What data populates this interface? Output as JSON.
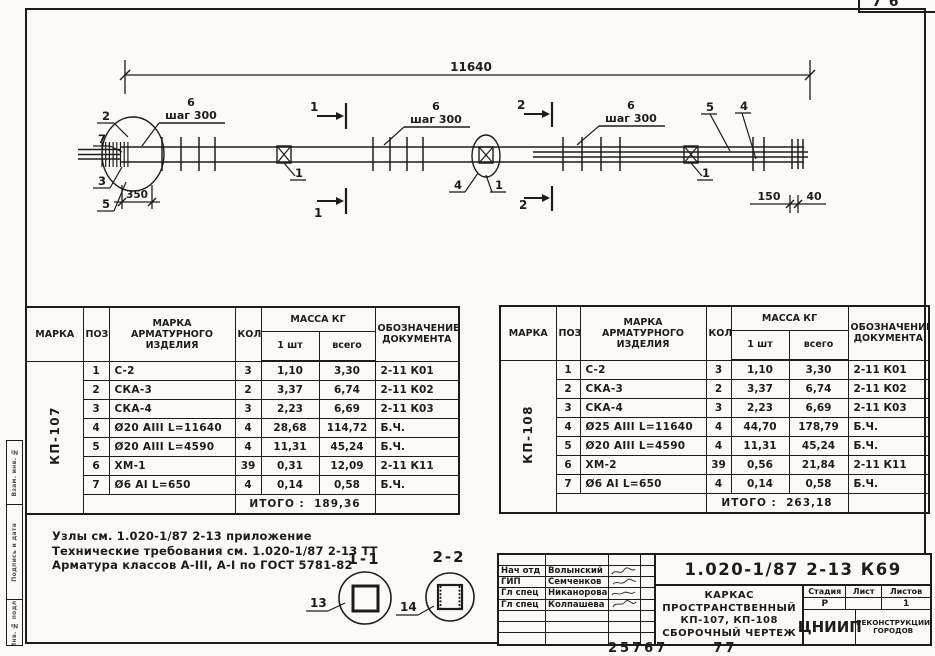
{
  "page": {
    "sheet_number": "76",
    "archive_note": "25767      77",
    "ink_color": "#1e1c18",
    "paper_color": "#fbfaf6"
  },
  "side_stamp": {
    "labels": [
      "Взам. инв. №",
      "Подпись и дата",
      "Инв. № подл."
    ]
  },
  "beam": {
    "overall_dim": "11640",
    "left_offset_dim": "350",
    "right_dim_150": "150",
    "right_dim_40": "40",
    "step_label": "шаг 300",
    "pos_1": "1",
    "pos_2": "2",
    "pos_3": "3",
    "pos_4": "4",
    "pos_5": "5",
    "pos_6": "6",
    "pos_7": "7",
    "section_mark_1": "1",
    "section_mark_2": "2"
  },
  "sections": {
    "s1": {
      "title": "1-1",
      "callout": "13"
    },
    "s2": {
      "title": "2-2",
      "callout": "14"
    }
  },
  "notes": {
    "line1": "Узлы см. 1.020-1/87 2-13 приложение",
    "line2": "Технические требования см. 1.020-1/87 2-13 ТТ",
    "line3": "Арматура классов А-III, А-I по ГОСТ 5781-82"
  },
  "spec": {
    "headers": {
      "mark": "МАРКА",
      "pos": "ПОЗ",
      "item": "МАРКА\nАРМАТУРНОГО\nИЗДЕЛИЯ",
      "qty": "КОЛ",
      "mass": "МАССА КГ",
      "per_item": "1 шт",
      "total": "всего",
      "doc": "ОБОЗНАЧЕНИЕ\nДОКУМЕНТА"
    },
    "total_label": "ИТОГО :",
    "left": {
      "mark": "КП-107",
      "rows": [
        {
          "pos": "1",
          "item": "С-2",
          "qty": "3",
          "m1": "1,10",
          "mt": "3,30",
          "doc": "2-11 К01"
        },
        {
          "pos": "2",
          "item": "СКА-3",
          "qty": "2",
          "m1": "3,37",
          "mt": "6,74",
          "doc": "2-11 К02"
        },
        {
          "pos": "3",
          "item": "СКА-4",
          "qty": "3",
          "m1": "2,23",
          "mt": "6,69",
          "doc": "2-11 К03"
        },
        {
          "pos": "4",
          "item": "Ø20 АIII   L=11640",
          "qty": "4",
          "m1": "28,68",
          "mt": "114,72",
          "doc": "Б.Ч."
        },
        {
          "pos": "5",
          "item": "Ø20 АIII   L=4590",
          "qty": "4",
          "m1": "11,31",
          "mt": "45,24",
          "doc": "Б.Ч."
        },
        {
          "pos": "6",
          "item": "ХМ-1",
          "qty": "39",
          "m1": "0,31",
          "mt": "12,09",
          "doc": "2-11 К11"
        },
        {
          "pos": "7",
          "item": "Ø6 АI   L=650",
          "qty": "4",
          "m1": "0,14",
          "mt": "0,58",
          "doc": "Б.Ч."
        }
      ],
      "total": "189,36"
    },
    "right": {
      "mark": "КП-108",
      "rows": [
        {
          "pos": "1",
          "item": "С-2",
          "qty": "3",
          "m1": "1,10",
          "mt": "3,30",
          "doc": "2-11 К01"
        },
        {
          "pos": "2",
          "item": "СКА-3",
          "qty": "2",
          "m1": "3,37",
          "mt": "6,74",
          "doc": "2-11 К02"
        },
        {
          "pos": "3",
          "item": "СКА-4",
          "qty": "3",
          "m1": "2,23",
          "mt": "6,69",
          "doc": "2-11 К03"
        },
        {
          "pos": "4",
          "item": "Ø25 АIII   L=11640",
          "qty": "4",
          "m1": "44,70",
          "mt": "178,79",
          "doc": "Б.Ч."
        },
        {
          "pos": "5",
          "item": "Ø20 АIII   L=4590",
          "qty": "4",
          "m1": "11,31",
          "mt": "45,24",
          "doc": "Б.Ч."
        },
        {
          "pos": "6",
          "item": "ХМ-2",
          "qty": "39",
          "m1": "0,56",
          "mt": "21,84",
          "doc": "2-11 К11"
        },
        {
          "pos": "7",
          "item": "Ø6 АI   L=650",
          "qty": "4",
          "m1": "0,14",
          "mt": "0,58",
          "doc": "Б.Ч."
        }
      ],
      "total": "263,18"
    }
  },
  "title_block": {
    "doc_number": "1.020-1/87 2-13 К69",
    "staff": [
      {
        "role": "Нач отд",
        "name": "Волынский"
      },
      {
        "role": "ГИП",
        "name": "Семченков"
      },
      {
        "role": "Гл спец",
        "name": "Никанорова"
      },
      {
        "role": "Гл спец",
        "name": "Колпашева"
      }
    ],
    "title": "КАРКАС\nПРОСТРАНСТВЕННЫЙ\nКП-107, КП-108\nСБОРОЧНЫЙ ЧЕРТЕЖ",
    "stage_label": "Стадия",
    "sheet_label": "Лист",
    "sheets_label": "Листов",
    "stage": "Р",
    "sheet": "",
    "sheets": "1",
    "org": "ЦНИИП",
    "org_sub": "РЕКОНСТРУКЦИИ\nГОРОДОВ"
  }
}
